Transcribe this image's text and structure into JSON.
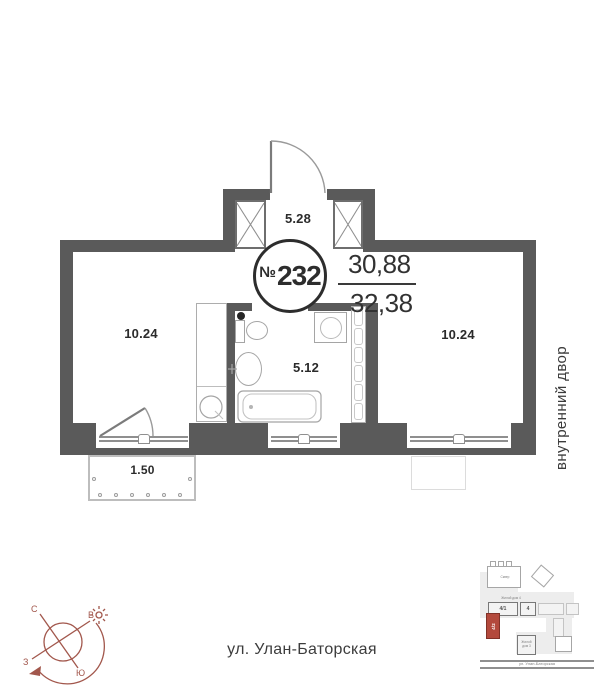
{
  "colors": {
    "wall": "#5a5a5a",
    "compass": "#a2574c",
    "highlight": "#b3493c"
  },
  "plan": {
    "unit_prefix": "№",
    "unit_number": "232",
    "area_top": "30,88",
    "area_bottom": "32,38",
    "hall_area": "5.28",
    "room_left_area": "10.24",
    "bathroom_area": "5.12",
    "room_right_area": "10.24",
    "balcony_area": "1.50",
    "courtyard_label": "внутренний двор",
    "street_label": "ул. Улан-Баторская"
  },
  "compass": {
    "north": "С",
    "east": "В",
    "south": "Ю",
    "west": "З"
  },
  "minimap": {
    "park_label": "Сквер",
    "row_label": "Жилой дом 4",
    "block_a": "4/1",
    "block_b": "4",
    "highlight_block": "4/2",
    "house3_line1": "Жилой",
    "house3_line2": "дом 3",
    "street_label": "ул. Улан-Баторская"
  }
}
